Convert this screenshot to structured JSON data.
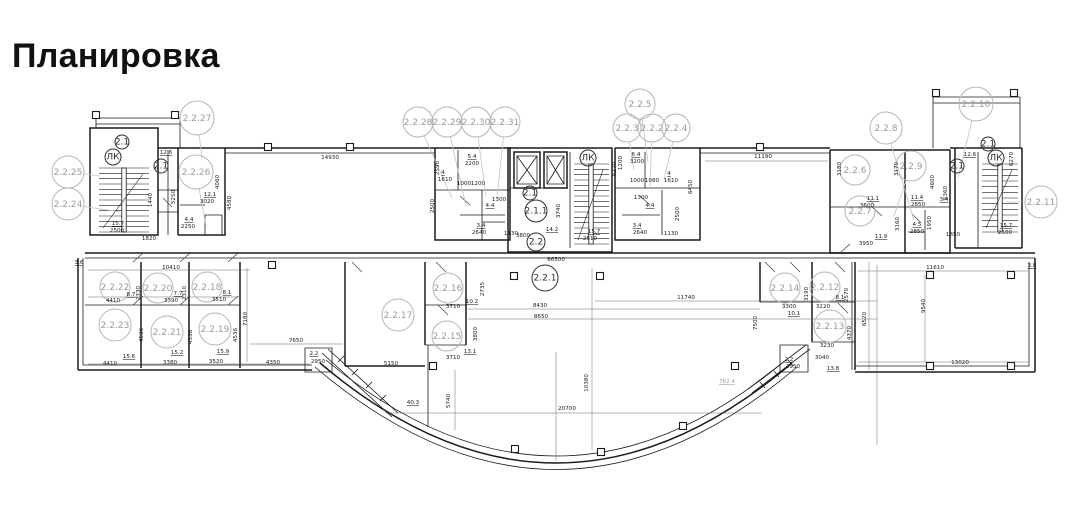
{
  "page_title": "Планировка",
  "plan": {
    "room_markers": [
      {
        "label": "2.2.25",
        "x": 68,
        "y": 172,
        "r": 16,
        "lx": 100,
        "ly": 176
      },
      {
        "label": "2.2.24",
        "x": 68,
        "y": 204,
        "r": 16,
        "lx": 120,
        "ly": 212
      },
      {
        "label": "2.2.27",
        "x": 197,
        "y": 118,
        "r": 17,
        "lx": 202,
        "ly": 158
      },
      {
        "label": "2.2.26",
        "x": 196,
        "y": 172,
        "r": 17,
        "lx": 206,
        "ly": 226
      },
      {
        "label": "2.2.28",
        "x": 418,
        "y": 122,
        "r": 15,
        "lx": 452,
        "ly": 198
      },
      {
        "label": "2.2.29",
        "x": 447,
        "y": 122,
        "r": 15,
        "lx": 466,
        "ly": 206
      },
      {
        "label": "2.2.30",
        "x": 476,
        "y": 122,
        "r": 15,
        "lx": 486,
        "ly": 196
      },
      {
        "label": "2.2.31",
        "x": 505,
        "y": 122,
        "r": 15,
        "lx": 497,
        "ly": 198
      },
      {
        "label": "2.2.5",
        "x": 640,
        "y": 104,
        "r": 15,
        "lx": 648,
        "ly": 162
      },
      {
        "label": "2.2.3",
        "x": 627,
        "y": 128,
        "r": 14,
        "lx": 634,
        "ly": 170
      },
      {
        "label": "2.2.2",
        "x": 652,
        "y": 128,
        "r": 14,
        "lx": 650,
        "ly": 186
      },
      {
        "label": "2.2.4",
        "x": 676,
        "y": 128,
        "r": 14,
        "lx": 664,
        "ly": 180
      },
      {
        "label": "2.2.8",
        "x": 886,
        "y": 128,
        "r": 16,
        "lx": 914,
        "ly": 220
      },
      {
        "label": "2.2.10",
        "x": 976,
        "y": 104,
        "r": 17,
        "lx": 958,
        "ly": 178
      },
      {
        "label": "2.2.6",
        "x": 855,
        "y": 170,
        "r": 15
      },
      {
        "label": "2.2.9",
        "x": 911,
        "y": 166,
        "r": 15,
        "lx": 894,
        "ly": 216
      },
      {
        "label": "2.2.7",
        "x": 860,
        "y": 211,
        "r": 15
      },
      {
        "label": "2.2.11",
        "x": 1041,
        "y": 202,
        "r": 16,
        "lx": 1006,
        "ly": 202
      },
      {
        "label": "2.2.22",
        "x": 115,
        "y": 287,
        "r": 15
      },
      {
        "label": "2.2.20",
        "x": 158,
        "y": 288,
        "r": 15
      },
      {
        "label": "2.2.18",
        "x": 207,
        "y": 287,
        "r": 15
      },
      {
        "label": "2.2.23",
        "x": 115,
        "y": 325,
        "r": 16
      },
      {
        "label": "2.2.21",
        "x": 167,
        "y": 332,
        "r": 16
      },
      {
        "label": "2.2.19",
        "x": 215,
        "y": 329,
        "r": 16
      },
      {
        "label": "2.2.17",
        "x": 398,
        "y": 315,
        "r": 16
      },
      {
        "label": "2.2.16",
        "x": 448,
        "y": 288,
        "r": 15
      },
      {
        "label": "2.2.15",
        "x": 447,
        "y": 336,
        "r": 15
      },
      {
        "label": "2.2.14",
        "x": 785,
        "y": 288,
        "r": 15
      },
      {
        "label": "2.2.12",
        "x": 825,
        "y": 287,
        "r": 15
      },
      {
        "label": "2.2.13",
        "x": 830,
        "y": 326,
        "r": 16
      }
    ],
    "core_markers": [
      {
        "label": "2.2.1",
        "x": 545,
        "y": 278,
        "r": 13
      },
      {
        "label": "2.1.1",
        "x": 536,
        "y": 211,
        "r": 11
      },
      {
        "label": "2.1",
        "x": 530,
        "y": 193,
        "r": 7
      },
      {
        "label": "2.2",
        "x": 536,
        "y": 242,
        "r": 9
      },
      {
        "label": "ЛК",
        "x": 113,
        "y": 157,
        "r": 8
      },
      {
        "label": "ЛК",
        "x": 588,
        "y": 158,
        "r": 8
      },
      {
        "label": "ЛК",
        "x": 996,
        "y": 158,
        "r": 8
      },
      {
        "label": "2.1",
        "x": 122,
        "y": 142,
        "r": 7
      },
      {
        "label": "2.1",
        "x": 161,
        "y": 166,
        "r": 7
      },
      {
        "label": "2.1",
        "x": 988,
        "y": 144,
        "r": 7
      },
      {
        "label": "2.1",
        "x": 957,
        "y": 166,
        "r": 7
      }
    ],
    "dim_labels": [
      {
        "t": "12.6",
        "x": 166,
        "y": 154,
        "u": 1
      },
      {
        "t": "15.7",
        "x": 118,
        "y": 225,
        "u": 1
      },
      {
        "t": "2500",
        "x": 117,
        "y": 232
      },
      {
        "t": "1820",
        "x": 149,
        "y": 240
      },
      {
        "t": "12.1",
        "x": 210,
        "y": 196,
        "u": 1
      },
      {
        "t": "3020",
        "x": 207,
        "y": 203
      },
      {
        "t": "4.4",
        "x": 189,
        "y": 221,
        "u": 1
      },
      {
        "t": "2250",
        "x": 188,
        "y": 228
      },
      {
        "t": "5250",
        "x": 175,
        "y": 197,
        "r": 1
      },
      {
        "t": "1440",
        "x": 152,
        "y": 200,
        "r": 1
      },
      {
        "t": "4060",
        "x": 219,
        "y": 182,
        "r": 1
      },
      {
        "t": "4580",
        "x": 231,
        "y": 203,
        "r": 1
      },
      {
        "t": "14930",
        "x": 330,
        "y": 159
      },
      {
        "t": "5.4",
        "x": 472,
        "y": 158,
        "u": 1
      },
      {
        "t": "2200",
        "x": 472,
        "y": 165
      },
      {
        "t": "4",
        "x": 443,
        "y": 174,
        "u": 1
      },
      {
        "t": "1610",
        "x": 445,
        "y": 181
      },
      {
        "t": "1000",
        "x": 464,
        "y": 185
      },
      {
        "t": "1200",
        "x": 478,
        "y": 185
      },
      {
        "t": "2590",
        "x": 439,
        "y": 168,
        "r": 1
      },
      {
        "t": "4.4",
        "x": 490,
        "y": 207,
        "u": 1
      },
      {
        "t": "1300",
        "x": 499,
        "y": 201
      },
      {
        "t": "3.4",
        "x": 481,
        "y": 227,
        "u": 1
      },
      {
        "t": "2640",
        "x": 479,
        "y": 234
      },
      {
        "t": "1130",
        "x": 511,
        "y": 235
      },
      {
        "t": "2500",
        "x": 434,
        "y": 206,
        "r": 1
      },
      {
        "t": "3800",
        "x": 523,
        "y": 237
      },
      {
        "t": "14.2",
        "x": 552,
        "y": 231,
        "u": 1
      },
      {
        "t": "3740",
        "x": 560,
        "y": 211,
        "r": 1
      },
      {
        "t": "2510",
        "x": 590,
        "y": 240
      },
      {
        "t": "15.7",
        "x": 594,
        "y": 233,
        "u": 1
      },
      {
        "t": "6270",
        "x": 616,
        "y": 169,
        "r": 1
      },
      {
        "t": "6.4",
        "x": 636,
        "y": 156,
        "u": 1
      },
      {
        "t": "3200",
        "x": 637,
        "y": 163
      },
      {
        "t": "1200",
        "x": 622,
        "y": 163,
        "r": 1
      },
      {
        "t": "1000",
        "x": 637,
        "y": 182
      },
      {
        "t": "1080",
        "x": 652,
        "y": 182
      },
      {
        "t": "4",
        "x": 669,
        "y": 175,
        "u": 1
      },
      {
        "t": "1610",
        "x": 671,
        "y": 182
      },
      {
        "t": "1300",
        "x": 641,
        "y": 199
      },
      {
        "t": "4.4",
        "x": 650,
        "y": 207,
        "u": 1
      },
      {
        "t": "3.4",
        "x": 637,
        "y": 227,
        "u": 1
      },
      {
        "t": "2640",
        "x": 640,
        "y": 234
      },
      {
        "t": "1130",
        "x": 671,
        "y": 235
      },
      {
        "t": "2500",
        "x": 679,
        "y": 214,
        "r": 1
      },
      {
        "t": "6450",
        "x": 692,
        "y": 187,
        "r": 1
      },
      {
        "t": "11190",
        "x": 763,
        "y": 158
      },
      {
        "t": "3180",
        "x": 841,
        "y": 169,
        "r": 1
      },
      {
        "t": "3170",
        "x": 898,
        "y": 169,
        "r": 1
      },
      {
        "t": "11.1",
        "x": 873,
        "y": 200,
        "u": 1
      },
      {
        "t": "3600",
        "x": 867,
        "y": 207
      },
      {
        "t": "11.9",
        "x": 881,
        "y": 238,
        "u": 1
      },
      {
        "t": "3950",
        "x": 866,
        "y": 245
      },
      {
        "t": "3160",
        "x": 899,
        "y": 224,
        "r": 1
      },
      {
        "t": "11.4",
        "x": 917,
        "y": 199,
        "u": 1
      },
      {
        "t": "2850",
        "x": 918,
        "y": 206
      },
      {
        "t": "4600",
        "x": 934,
        "y": 182,
        "r": 1
      },
      {
        "t": "5360",
        "x": 947,
        "y": 193,
        "r": 1
      },
      {
        "t": "4.5",
        "x": 917,
        "y": 226,
        "u": 1
      },
      {
        "t": "2850",
        "x": 917,
        "y": 233
      },
      {
        "t": "1950",
        "x": 931,
        "y": 223,
        "r": 1
      },
      {
        "t": "1850",
        "x": 953,
        "y": 236
      },
      {
        "t": "3.4",
        "x": 944,
        "y": 201,
        "u": 1
      },
      {
        "t": "12.6",
        "x": 970,
        "y": 156,
        "u": 1
      },
      {
        "t": "15.7",
        "x": 1006,
        "y": 227,
        "u": 1
      },
      {
        "t": "2500",
        "x": 1005,
        "y": 234
      },
      {
        "t": "6270",
        "x": 1013,
        "y": 159,
        "r": 1
      },
      {
        "t": "3.6",
        "x": 79,
        "y": 264,
        "u": 1
      },
      {
        "t": "10410",
        "x": 171,
        "y": 269
      },
      {
        "t": "8.7",
        "x": 131,
        "y": 296,
        "u": 1
      },
      {
        "t": "4410",
        "x": 113,
        "y": 302
      },
      {
        "t": "7.7",
        "x": 178,
        "y": 295,
        "u": 1
      },
      {
        "t": "3390",
        "x": 171,
        "y": 302
      },
      {
        "t": "8.1",
        "x": 227,
        "y": 294,
        "u": 1
      },
      {
        "t": "3510",
        "x": 219,
        "y": 301
      },
      {
        "t": "2330",
        "x": 140,
        "y": 293,
        "r": 1
      },
      {
        "t": "2310",
        "x": 186,
        "y": 293,
        "r": 1
      },
      {
        "t": "15.6",
        "x": 129,
        "y": 358,
        "u": 1
      },
      {
        "t": "4410",
        "x": 110,
        "y": 365
      },
      {
        "t": "15.2",
        "x": 177,
        "y": 354,
        "u": 1
      },
      {
        "t": "3380",
        "x": 170,
        "y": 364
      },
      {
        "t": "15.9",
        "x": 223,
        "y": 353,
        "u": 1
      },
      {
        "t": "3520",
        "x": 216,
        "y": 363
      },
      {
        "t": "4350",
        "x": 273,
        "y": 364
      },
      {
        "t": "4536",
        "x": 143,
        "y": 335,
        "r": 1
      },
      {
        "t": "4536",
        "x": 192,
        "y": 337,
        "r": 1
      },
      {
        "t": "4536",
        "x": 237,
        "y": 335,
        "r": 1
      },
      {
        "t": "7180",
        "x": 247,
        "y": 319,
        "r": 1
      },
      {
        "t": "7650",
        "x": 296,
        "y": 342
      },
      {
        "t": "66500",
        "x": 556,
        "y": 261
      },
      {
        "t": "2.2",
        "x": 314,
        "y": 355,
        "u": 1
      },
      {
        "t": "2950",
        "x": 318,
        "y": 363
      },
      {
        "t": "5150",
        "x": 391,
        "y": 365
      },
      {
        "t": "40.3",
        "x": 413,
        "y": 404,
        "u": 1
      },
      {
        "t": "5740",
        "x": 450,
        "y": 401,
        "r": 1
      },
      {
        "t": "3710",
        "x": 453,
        "y": 308
      },
      {
        "t": "10.2",
        "x": 472,
        "y": 303,
        "u": 1
      },
      {
        "t": "3710",
        "x": 453,
        "y": 359
      },
      {
        "t": "13.1",
        "x": 470,
        "y": 353,
        "u": 1
      },
      {
        "t": "2735",
        "x": 484,
        "y": 289,
        "r": 1
      },
      {
        "t": "3800",
        "x": 477,
        "y": 334,
        "r": 1
      },
      {
        "t": "8430",
        "x": 540,
        "y": 307
      },
      {
        "t": "8650",
        "x": 541,
        "y": 318
      },
      {
        "t": "11740",
        "x": 686,
        "y": 299
      },
      {
        "t": "20700",
        "x": 567,
        "y": 410
      },
      {
        "t": "10380",
        "x": 588,
        "y": 383,
        "r": 1
      },
      {
        "t": "762.4",
        "x": 727,
        "y": 383,
        "u": 1,
        "g": 1
      },
      {
        "t": "2.2",
        "x": 789,
        "y": 361,
        "u": 1
      },
      {
        "t": "2950",
        "x": 793,
        "y": 368
      },
      {
        "t": "7500",
        "x": 757,
        "y": 323,
        "r": 1
      },
      {
        "t": "10.1",
        "x": 794,
        "y": 315,
        "u": 1
      },
      {
        "t": "3300",
        "x": 789,
        "y": 308
      },
      {
        "t": "3190",
        "x": 808,
        "y": 294,
        "r": 1
      },
      {
        "t": "8.1",
        "x": 840,
        "y": 299,
        "u": 1
      },
      {
        "t": "3220",
        "x": 823,
        "y": 308
      },
      {
        "t": "2570",
        "x": 848,
        "y": 295,
        "r": 1
      },
      {
        "t": "3230",
        "x": 827,
        "y": 347
      },
      {
        "t": "4370",
        "x": 851,
        "y": 333,
        "r": 1
      },
      {
        "t": "6520",
        "x": 866,
        "y": 319,
        "r": 1
      },
      {
        "t": "3040",
        "x": 822,
        "y": 359
      },
      {
        "t": "13.8",
        "x": 833,
        "y": 370,
        "u": 1
      },
      {
        "t": "11610",
        "x": 935,
        "y": 269
      },
      {
        "t": "9540",
        "x": 925,
        "y": 306,
        "r": 1
      },
      {
        "t": "13020",
        "x": 960,
        "y": 364
      },
      {
        "t": "3.8",
        "x": 1032,
        "y": 267,
        "u": 1
      }
    ]
  }
}
